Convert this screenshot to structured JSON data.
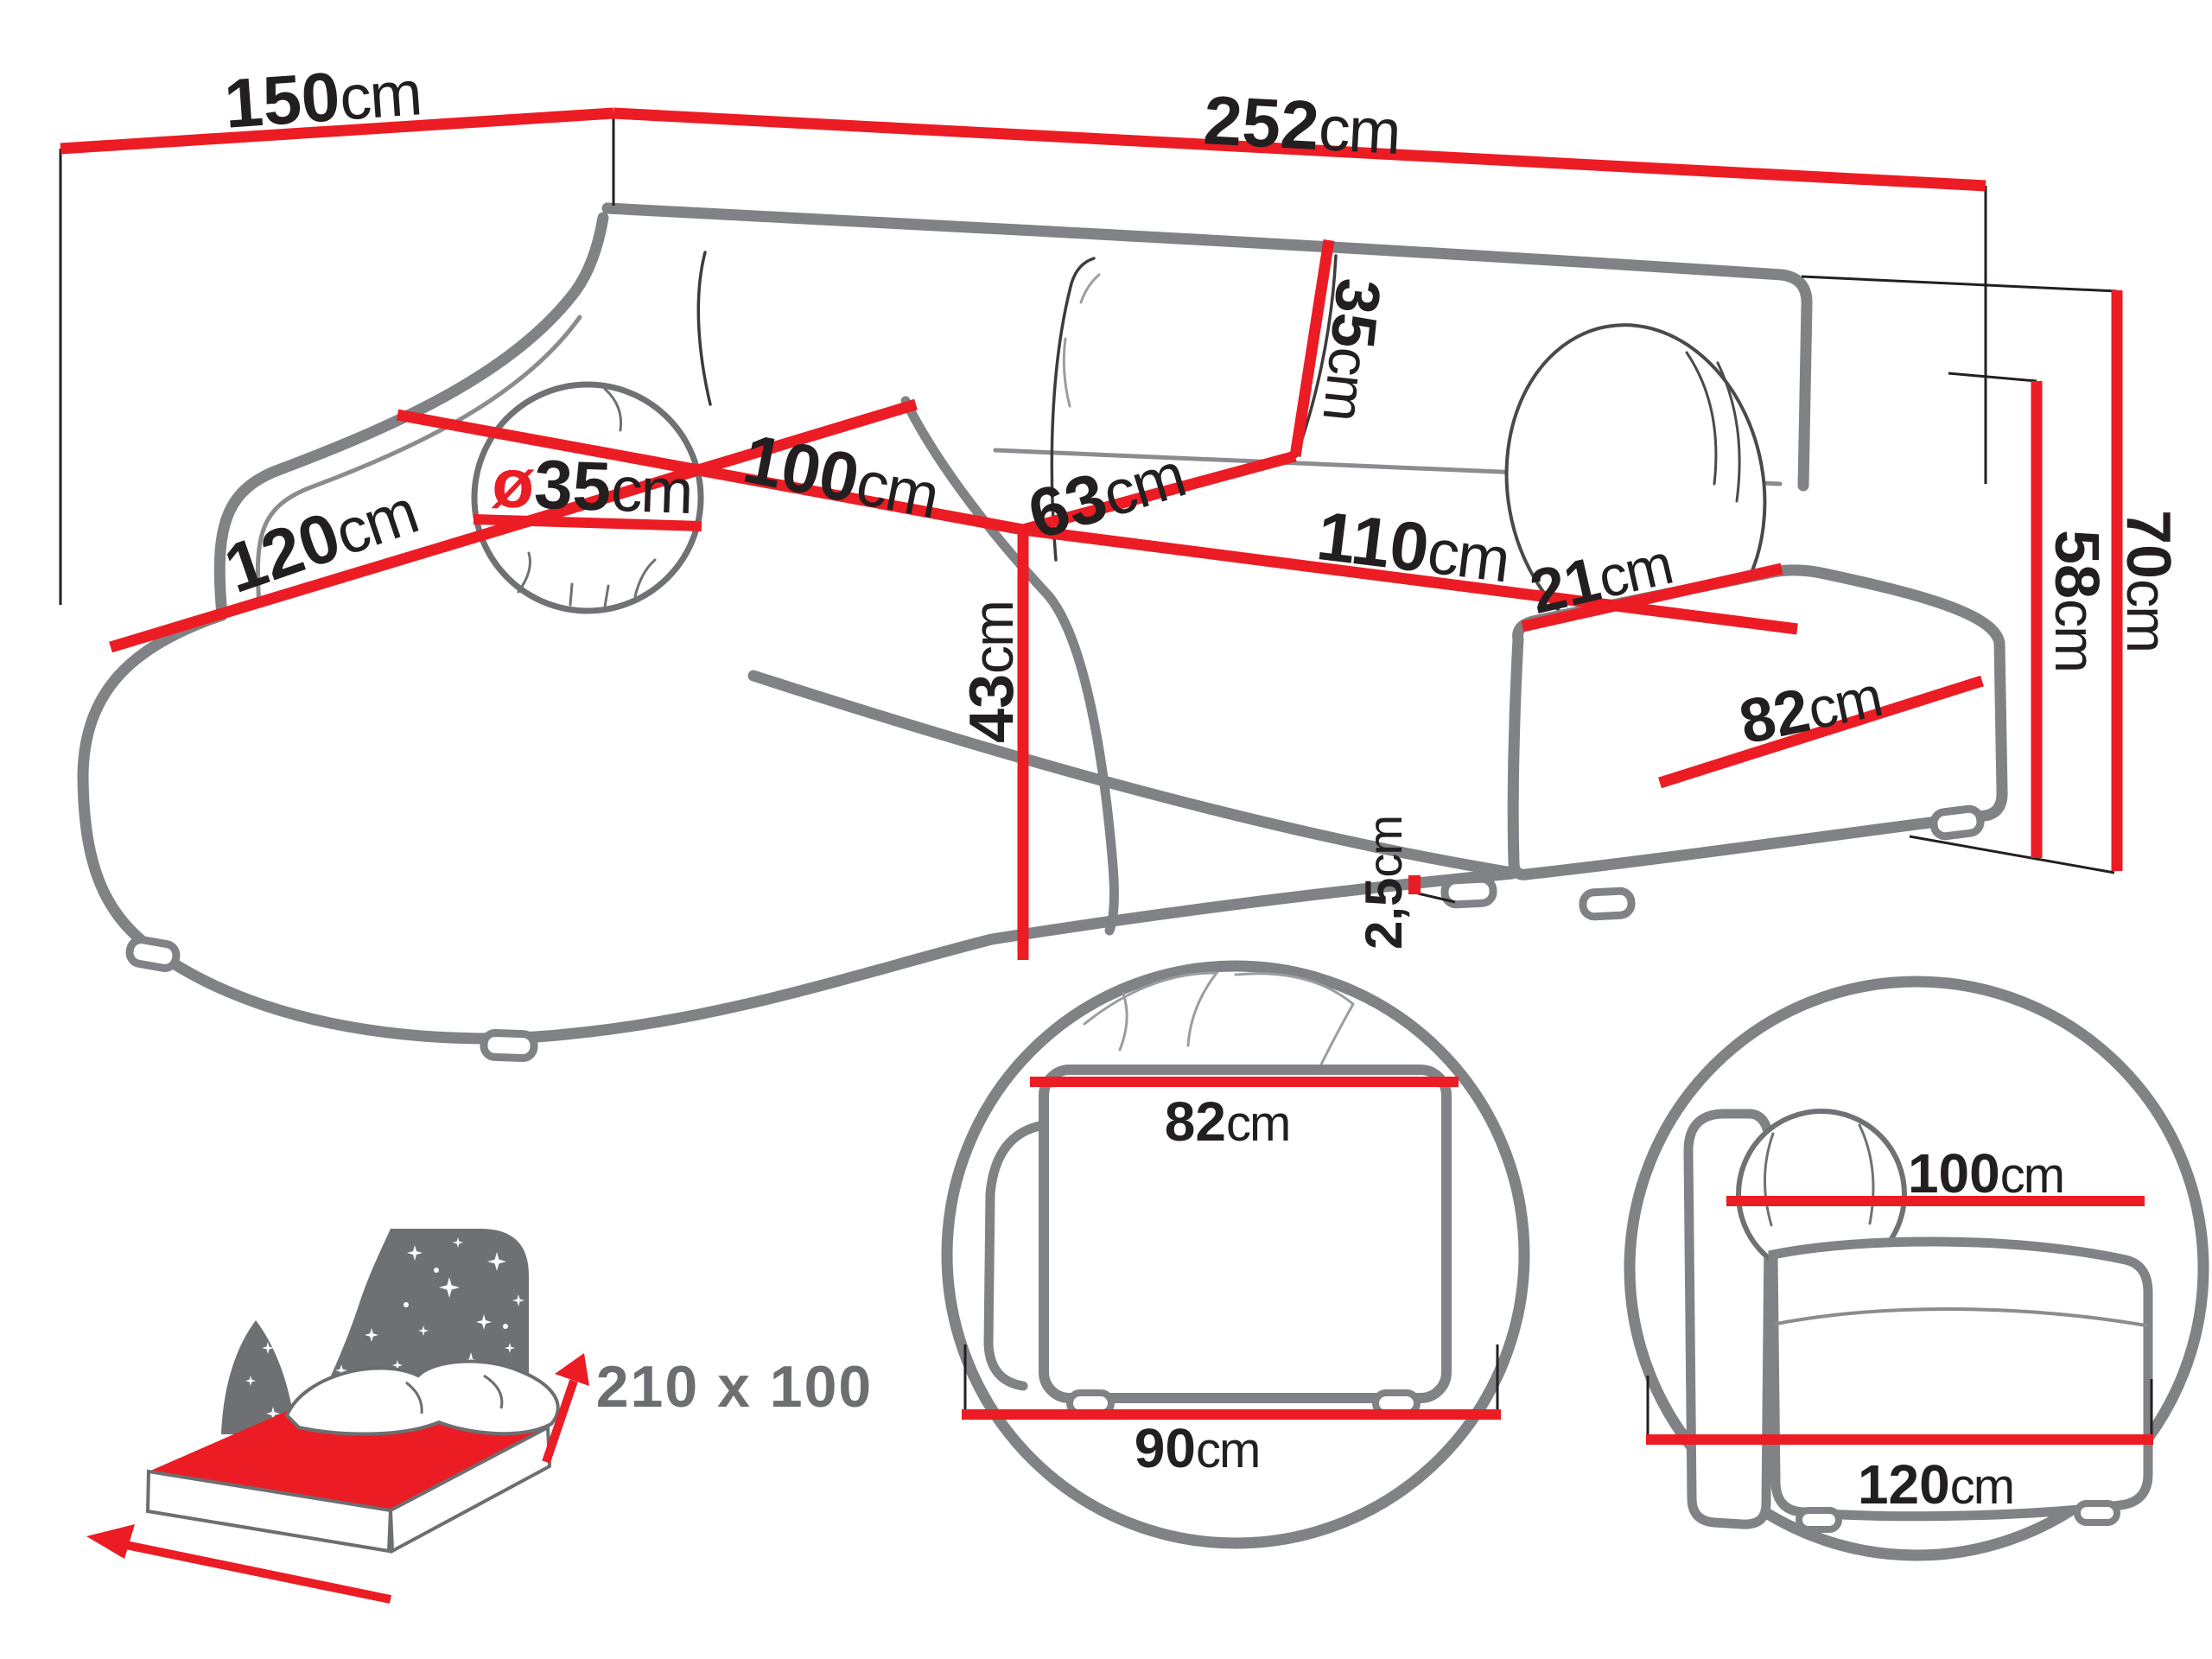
{
  "title": "Corner sofa dimension diagram",
  "colors": {
    "accent_red": "#ec1c24",
    "sofa_outline_gray": "#808285",
    "text_black": "#231f20",
    "bed_gray": "#6d6e71"
  },
  "dims": {
    "d150": {
      "num": "150",
      "unit": "cm"
    },
    "d252": {
      "num": "252",
      "unit": "cm"
    },
    "dia35": {
      "sym": "ø",
      "num": "35",
      "unit": "cm"
    },
    "d120": {
      "num": "120",
      "unit": "cm"
    },
    "d100": {
      "num": "100",
      "unit": "cm"
    },
    "d63": {
      "num": "63",
      "unit": "cm"
    },
    "d110": {
      "num": "110",
      "unit": "cm"
    },
    "d35": {
      "num": "35",
      "unit": "cm"
    },
    "d43": {
      "num": "43",
      "unit": "cm"
    },
    "d21": {
      "num": "21",
      "unit": "cm"
    },
    "d82": {
      "num": "82",
      "unit": "cm"
    },
    "d58": {
      "num": "58",
      "unit": "cm"
    },
    "d70": {
      "num": "70",
      "unit": "cm"
    },
    "d25": {
      "num": "2,5",
      "unit": "cm"
    }
  },
  "detail_side_view": {
    "top": {
      "num": "82",
      "unit": "cm"
    },
    "bottom": {
      "num": "90",
      "unit": "cm"
    }
  },
  "detail_front_view": {
    "top": {
      "num": "100",
      "unit": "cm"
    },
    "bottom": {
      "num": "120",
      "unit": "cm"
    }
  },
  "bed": {
    "sleeping_area": "210 x 100"
  }
}
